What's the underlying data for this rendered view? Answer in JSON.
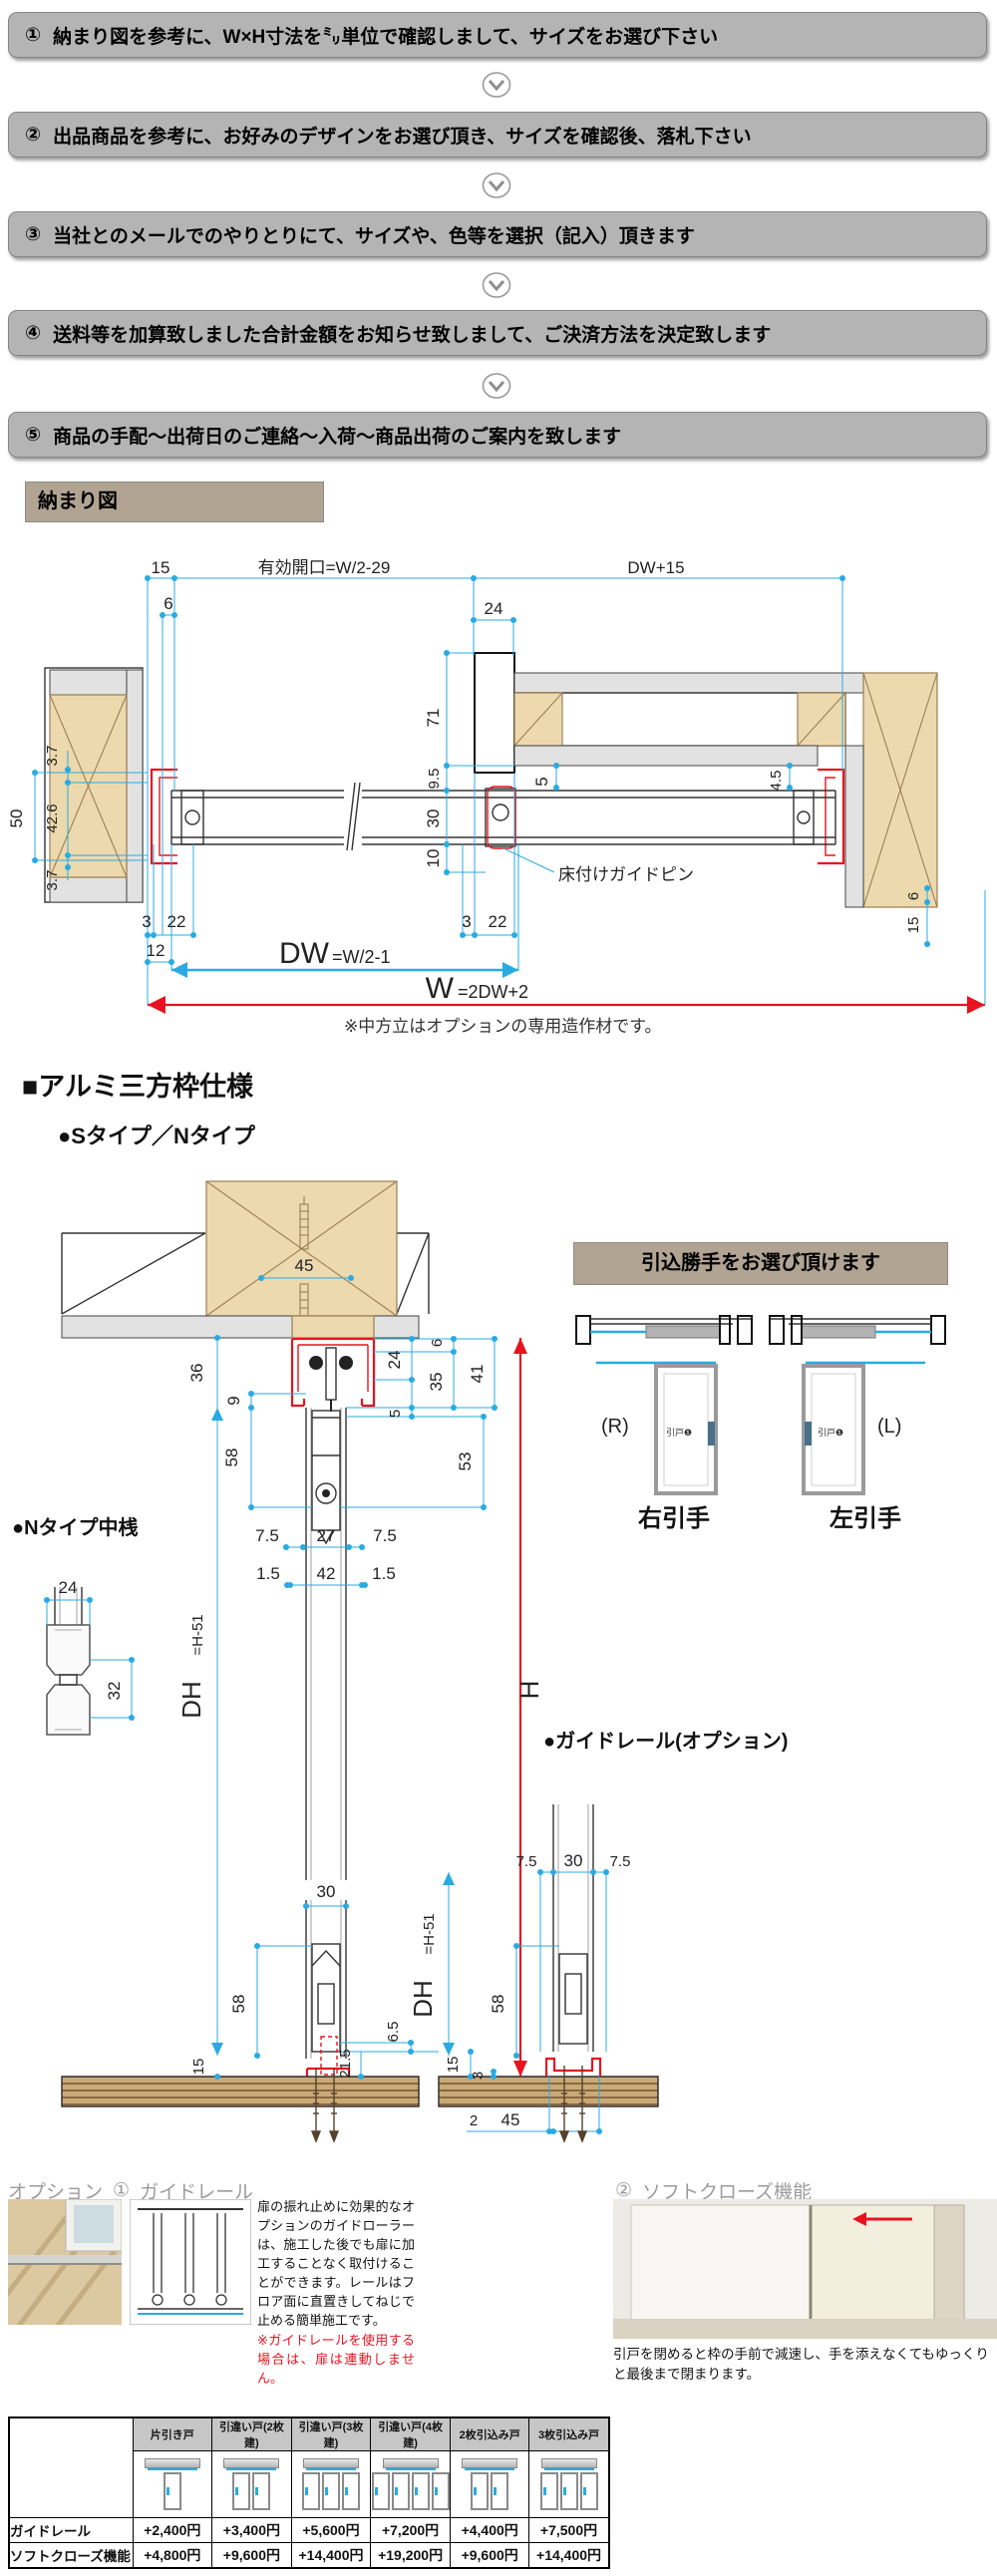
{
  "colors": {
    "dim_cyan": "#29abe2",
    "highlight_red": "#e8131f",
    "banner_gray": "#b4b4b4",
    "label_tan": "#b1a493",
    "wood": "#ecd9ae",
    "floor_brown": "#c9a977"
  },
  "steps": {
    "items": [
      {
        "num": "①",
        "text": "納まり図を参考に、W×H寸法を㍉単位で確認しまして、サイズをお選び下さい"
      },
      {
        "num": "②",
        "text": "出品商品を参考に、お好みのデザインをお選び頂き、サイズを確認後、落札下さい"
      },
      {
        "num": "③",
        "text": "当社とのメールでのやりとりにて、サイズや、色等を選択（記入）頂きます"
      },
      {
        "num": "④",
        "text": "送料等を加算致しました合計金額をお知らせ致しまして、ご決済方法を決定致します"
      },
      {
        "num": "⑤",
        "text": "商品の手配～出荷日のご連絡～入荷～商品出荷のご案内を致します"
      }
    ]
  },
  "osamari_label": "納まり図",
  "d1": {
    "t15": "15",
    "t6": "6",
    "eff": "有効開口=W/2-29",
    "dw15": "DW+15",
    "t24": "24",
    "l37a": "3.7",
    "l426": "42.6",
    "l37b": "3.7",
    "l50": "50",
    "v71": "71",
    "v95": "9.5",
    "v30": "30",
    "v10": "10",
    "v5": "5",
    "v45": "4.5",
    "b3l": "3",
    "b22l": "22",
    "b3r": "3",
    "b22r": "22",
    "b12": "12",
    "r6": "6",
    "r15": "15",
    "dw": "DW",
    "dweq": "=W/2-1",
    "w": "W",
    "weq": "=2DW+2",
    "pin": "床付けガイドピン",
    "note": "※中方立はオプションの専用造作材です。"
  },
  "sec1": {
    "h1": "■アルミ三方枠仕様",
    "h2": "●Sタイプ／Nタイプ"
  },
  "d2": {
    "t45": "45",
    "t36": "36",
    "t9": "9",
    "t58a": "58",
    "t24": "24",
    "t6": "6",
    "t35": "35",
    "t41": "41",
    "t5": "5",
    "t53": "53",
    "t75a": "7.5",
    "t27": "27",
    "t75b": "7.5",
    "t15a": "1.5",
    "t42": "42",
    "t15b": "1.5",
    "dh": "DH",
    "dheq": "=H-51",
    "h": "H",
    "t30": "30",
    "t58b": "58",
    "t65": "6.5",
    "t15f": "15",
    "t215": "21.5"
  },
  "nakazan": {
    "title": "●Nタイプ中桟",
    "t24": "24",
    "t32": "32"
  },
  "d4": {
    "title": "●ガイドレール(オプション)",
    "t75a": "7.5",
    "t30": "30",
    "t75b": "7.5",
    "dh": "DH",
    "dheq": "=H-51",
    "t58": "58",
    "t15": "15",
    "t3": "3",
    "t2": "2",
    "t45": "45"
  },
  "hikikomi": {
    "banner": "引込勝手をお選び頂けます",
    "r": "(R)",
    "l": "(L)",
    "right_label": "右引手",
    "left_label": "左引手",
    "door_tag": "引戸❶"
  },
  "options": {
    "title1_pre": "オプション",
    "title1_num": "①",
    "title1": "ガイドレール",
    "title2_num": "②",
    "title2": "ソフトクローズ機能",
    "body1": "扉の振れ止めに効果的なオプションのガイドローラーは、施工した後でも扉に加工することなく取付けることができます。レールはフロア面に直置きしてねじで止める簡単施工です。",
    "note1": "※ガイドレールを使用する場合は、扉は連動しません。",
    "body2": "引戸を閉めると枠の手前で減速し、手を添えなくてもゆっくりと最後まで閉まります。"
  },
  "table": {
    "col_headers": [
      "片引き戸",
      "引違い戸(2枚建)",
      "引違い戸(3枚建)",
      "引違い戸(4枚建)",
      "2枚引込み戸",
      "3枚引込み戸"
    ],
    "rows": [
      {
        "label": "ガイドレール",
        "values": [
          "+2,400円",
          "+3,400円",
          "+5,600円",
          "+7,200円",
          "+4,400円",
          "+7,500円"
        ]
      },
      {
        "label": "ソフトクローズ機能",
        "values": [
          "+4,800円",
          "+9,600円",
          "+14,400円",
          "+19,200円",
          "+9,600円",
          "+14,400円"
        ]
      }
    ]
  }
}
